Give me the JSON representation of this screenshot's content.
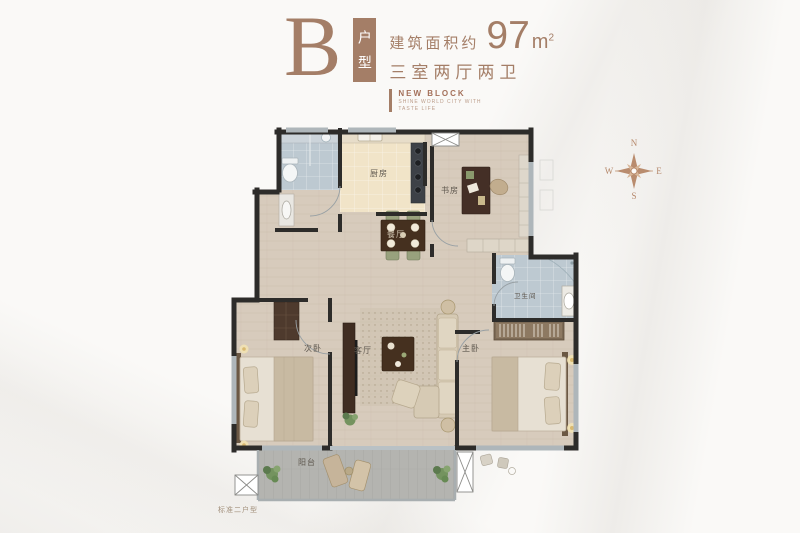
{
  "header": {
    "plan_letter": "B",
    "plan_tag_vertical": "户型",
    "area_prefix": "建筑面积约",
    "area_value": "97",
    "area_unit": "m",
    "area_sup": "2",
    "layout_desc": "三室两厅两卫",
    "block_title": "NEW BLOCK",
    "block_sub1": "SHINE WORLD CITY WITH",
    "block_sub2": "TASTE LIFE",
    "accent_color": "#a47e67"
  },
  "compass": {
    "n": "N",
    "e": "E",
    "s": "S",
    "w": "W"
  },
  "plan": {
    "rooms": [
      {
        "id": "kitchen",
        "label": "厨房"
      },
      {
        "id": "study",
        "label": "书房"
      },
      {
        "id": "dining",
        "label": "餐厅"
      },
      {
        "id": "living",
        "label": "客厅"
      },
      {
        "id": "bedroom-second",
        "label": "次卧"
      },
      {
        "id": "bedroom-master",
        "label": "主卧"
      },
      {
        "id": "bathroom",
        "label": "卫生间"
      },
      {
        "id": "balcony",
        "label": "阳台"
      }
    ]
  },
  "footer": {
    "caption": "标准二户型"
  },
  "colors": {
    "accent": "#a47e67",
    "wall": "#2d2c2a",
    "wood_floor": "#d7cbbc",
    "bath_tile": "#bdc9d1",
    "kitchen_tile": "#f1e4c8",
    "balcony_tile": "#b4b4b0"
  }
}
